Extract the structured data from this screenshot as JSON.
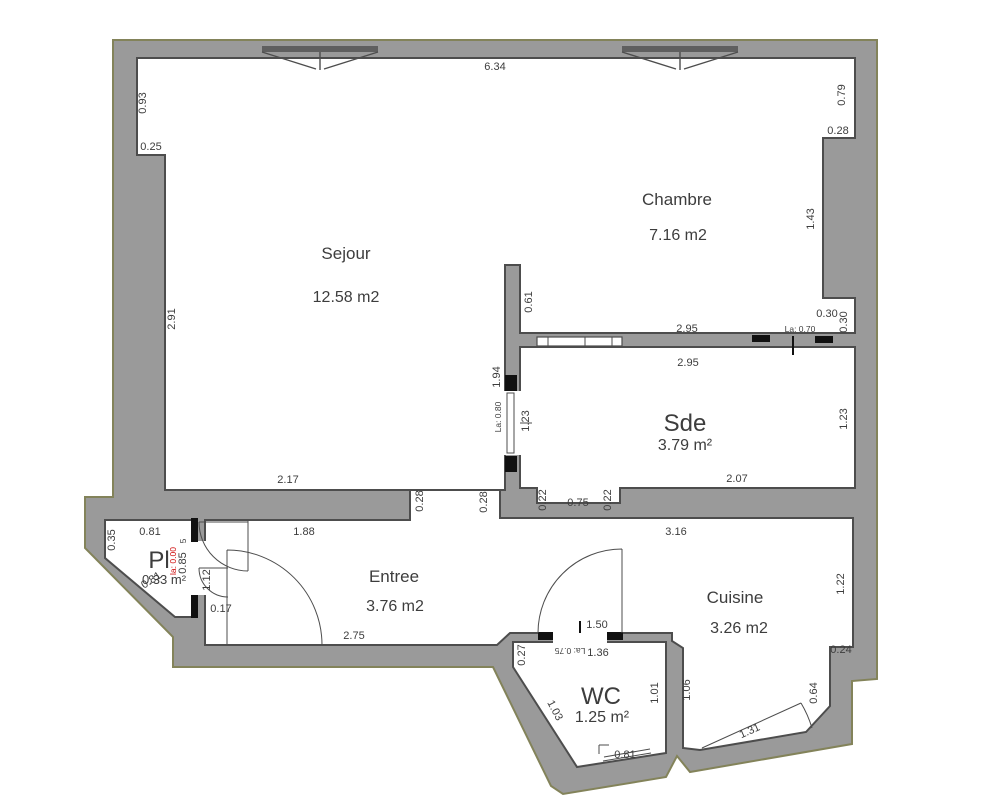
{
  "rooms": {
    "sejour": {
      "name": "Sejour",
      "area": "12.58 m2"
    },
    "chambre": {
      "name": "Chambre",
      "area": "7.16 m2"
    },
    "sde": {
      "name": "Sde",
      "area": "3.79 m²"
    },
    "entree": {
      "name": "Entree",
      "area": "3.76 m2"
    },
    "cuisine": {
      "name": "Cuisine",
      "area": "3.26 m2"
    },
    "wc": {
      "name": "WC",
      "area": "1.25 m²"
    },
    "pl": {
      "name": "Pl",
      "area": "0.33 m²"
    }
  },
  "dims": {
    "top_width": "6.34",
    "left_upper": "0.93",
    "left_step": "0.25",
    "sejour_left": "2.91",
    "sejour_bottom": "2.17",
    "chambre_right_upper": "0.79",
    "chambre_right_step": "0.28",
    "chambre_right_lower": "1.43",
    "chambre_notch_h": "0.30",
    "chambre_notch_v": "0.30",
    "wall_chambre_sde_top": "2.95",
    "wall_chambre_sde_bottom": "2.95",
    "door_chambre": "La: 0.70",
    "partition_top": "0.61",
    "partition_mid": "1.94",
    "door_sde": "La: 0.80",
    "sde_left": "1.23",
    "sde_right": "1.23",
    "sde_bottom": "2.07",
    "sejour_wall_end": "0.28",
    "sde_wall_start": "0.28",
    "niche_left": "0.22",
    "niche_width": "0.75",
    "niche_right": "0.22",
    "cuisine_wall_top": "3.16",
    "pl_left": "0.35",
    "pl_top": "0.81",
    "pl_diag": "0.81",
    "pl_door_width_red": "la: 0.00",
    "pl_right_upper": "0.85",
    "pl_right_upper_small": "5",
    "pl_right_mid": "1.12",
    "pl_right_lower": "0.17",
    "entree_top": "1.88",
    "entree_bottom": "2.75",
    "wc_top": "1.50",
    "door_wc": "La: 0.75",
    "wc_width": "1.36",
    "wc_left_step": "0.27",
    "wc_left_diag": "1.03",
    "wc_right_inner": "1.01",
    "wc_right_outer": "1.06",
    "wc_window": "0.81",
    "cuisine_right": "1.22",
    "cuisine_step": "0.24",
    "cuisine_right_lower": "0.64",
    "cuisine_door_diag": "1.31"
  },
  "colors": {
    "wall_fill": "#9a9a9a",
    "wall_outline": "#83835a",
    "interior_line": "#4d4d4d",
    "text": "#3d3d3d",
    "door_jamb": "#111111",
    "red_label": "#cc0000"
  }
}
